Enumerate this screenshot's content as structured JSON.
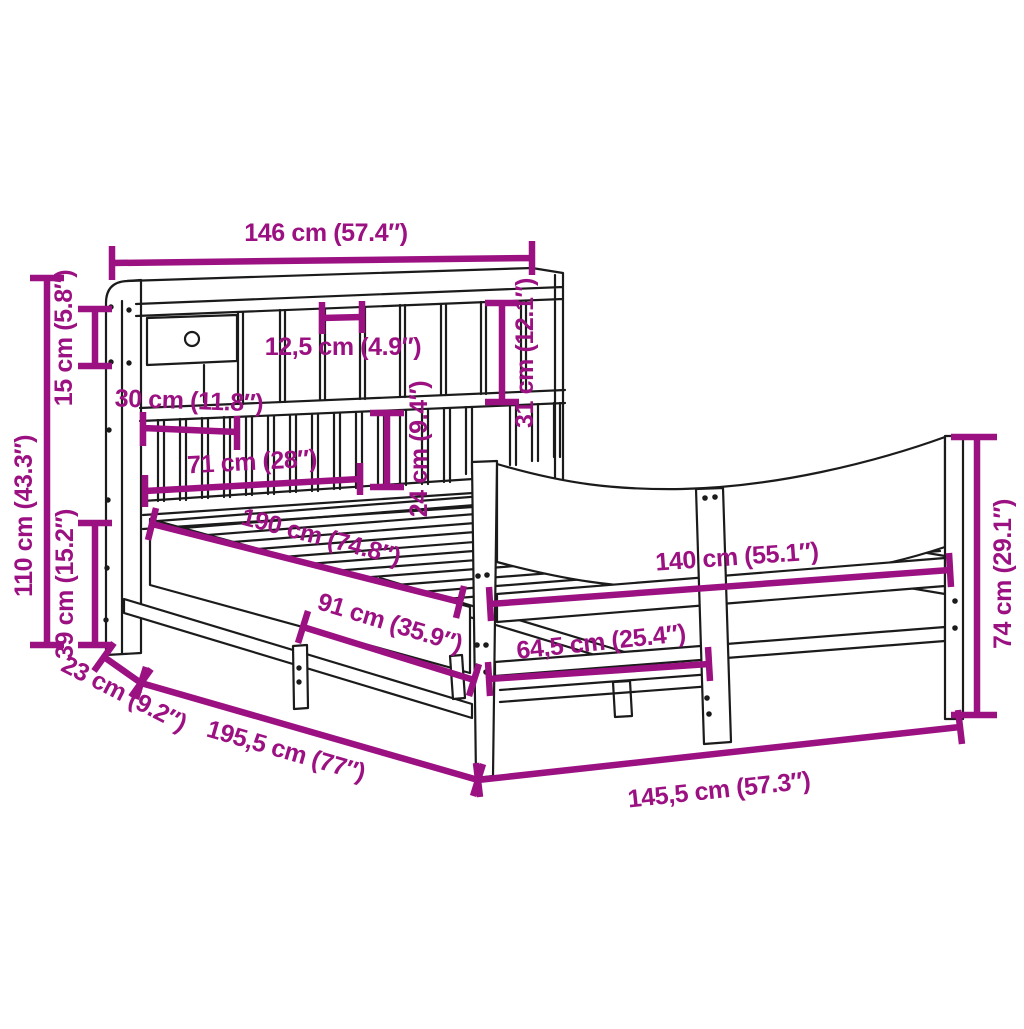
{
  "title": "Bed frame with bookcase headboard – dimension diagram",
  "colors": {
    "accent": "#9B1182",
    "line_art": "#1B1B1B",
    "background": "#FFFFFF"
  },
  "dimensions": {
    "headboard_width": {
      "label": "146 cm (57.4″)",
      "cm": 146,
      "inches": 57.4
    },
    "top_shelf_height": {
      "label": "15 cm (5.8″)",
      "cm": 15,
      "inches": 5.8
    },
    "headboard_total_height": {
      "label": "110 cm (43.3″)",
      "cm": 110,
      "inches": 43.3
    },
    "frame_base_height": {
      "label": "39 cm (15.2″)",
      "cm": 39,
      "inches": 15.2
    },
    "headboard_depth": {
      "label": "23 cm (9.2″)",
      "cm": 23,
      "inches": 9.2
    },
    "total_length": {
      "label": "195,5 cm (77″)",
      "cm": 195.5,
      "inches": 77
    },
    "total_width": {
      "label": "145,5 cm (57.3″)",
      "cm": 145.5,
      "inches": 57.3
    },
    "footboard_height": {
      "label": "74 cm (29.1″)",
      "cm": 74,
      "inches": 29.1
    },
    "mattress_width": {
      "label": "140 cm (55.1″)",
      "cm": 140,
      "inches": 55.1
    },
    "footboard_half_span": {
      "label": "64,5 cm (25.4″)",
      "cm": 64.5,
      "inches": 25.4
    },
    "side_support_span": {
      "label": "91 cm (35.9″)",
      "cm": 91,
      "inches": 35.9
    },
    "mattress_length": {
      "label": "190 cm (74.8″)",
      "cm": 190,
      "inches": 74.8
    },
    "shelf_to_base_gap": {
      "label": "24 cm (9.4″)",
      "cm": 24,
      "inches": 9.4
    },
    "cubby_height": {
      "label": "31 cm (12.1″)",
      "cm": 31,
      "inches": 12.1
    },
    "cubby_width": {
      "label": "12,5 cm (4.9″)",
      "cm": 12.5,
      "inches": 4.9
    },
    "drawer_section_width": {
      "label": "30 cm (11.8″)",
      "cm": 30,
      "inches": 11.8
    },
    "slat_section_width": {
      "label": "71 cm (28″)",
      "cm": 71,
      "inches": 28
    }
  }
}
